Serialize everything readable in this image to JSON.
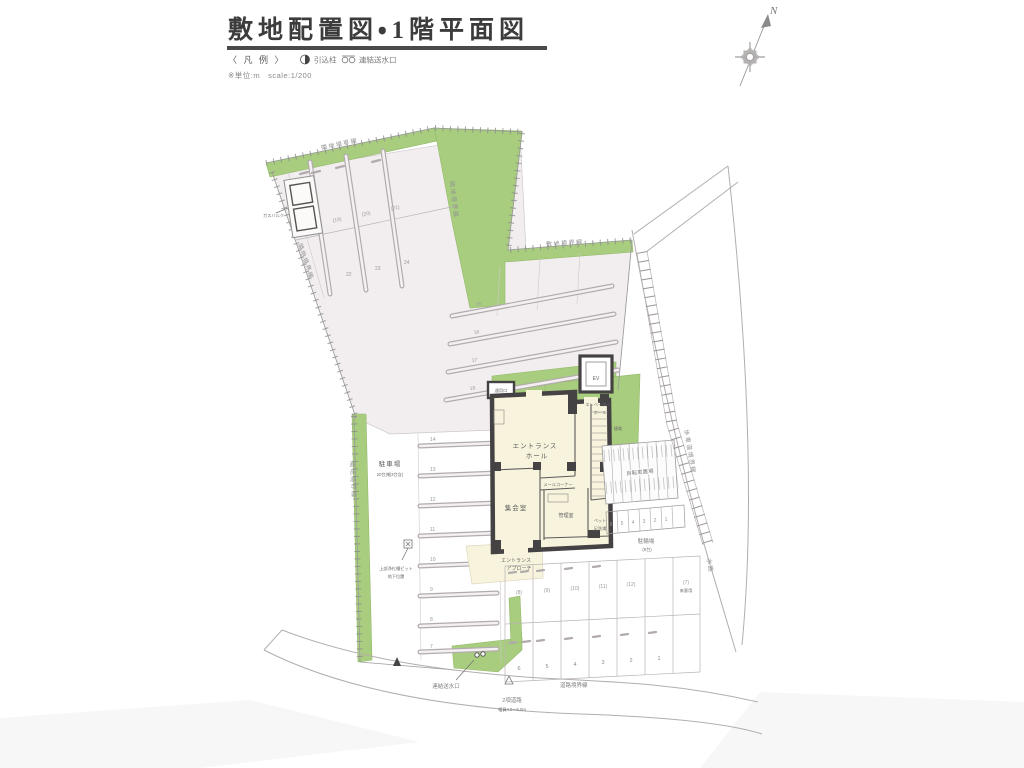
{
  "title": "敷地配置図・1階平面図",
  "legend": {
    "heading": "〈 凡 例 〉",
    "item1": "引込柱",
    "item2": "連結送水口",
    "note": "※単位:m　scale:1/200"
  },
  "compass": {
    "north": "N"
  },
  "boundaries": {
    "top": "隣地境界線",
    "left_diagonal": "隣地境界線",
    "left": "隣地境界線",
    "northeast": "隣地境界線",
    "site": "敷地境界線",
    "sidewalk": "歩車道境界線",
    "road": "道路境界線",
    "waterway": "水路"
  },
  "site": {
    "gas_label": "ガスバルク",
    "parking_label": "駐車場",
    "parking_count": "20台(軽3台含)",
    "pit_line1": "上部浄化槽ピット",
    "pit_line2": "地下位置",
    "approach_line1": "エントランス",
    "approach_line2": "アプローチ",
    "standpipe_label": "連結送水口",
    "road_line1": "2項道路",
    "road_line2": "幅員4.0〜5.0m",
    "bicycle_label": "自転車置場",
    "cycle_label": "駐輪場",
    "cycle_count": "(6台)",
    "guest_num": "(7)",
    "guest_label": "来客用",
    "planting_label": "植栽"
  },
  "building": {
    "ev": "EV",
    "evhall_line1": "エレベーター",
    "evhall_line2": "ホール",
    "hall_line1": "エントランス",
    "hall_line2": "ホール",
    "mail": "メールコーナー",
    "meeting": "集会室",
    "office": "管理室",
    "service": "通用口",
    "pet_line1": "ペット",
    "pet_line2": "足洗場"
  },
  "numbers": {
    "west": [
      "14",
      "13",
      "12",
      "11",
      "10",
      "9",
      "8",
      "7"
    ],
    "central": [
      "15",
      "16",
      "17",
      "18"
    ],
    "nw_mid": [
      "(19)",
      "(20)",
      "(21)"
    ],
    "nw_low": [
      "22",
      "23",
      "24"
    ],
    "se_top": [
      "(8)",
      "(9)",
      "(10)",
      "(11)",
      "(12)"
    ],
    "se_bottom": [
      "6",
      "5",
      "4",
      "3",
      "2",
      "1"
    ],
    "cycle": [
      "6",
      "5",
      "4",
      "3",
      "2",
      "1"
    ]
  }
}
